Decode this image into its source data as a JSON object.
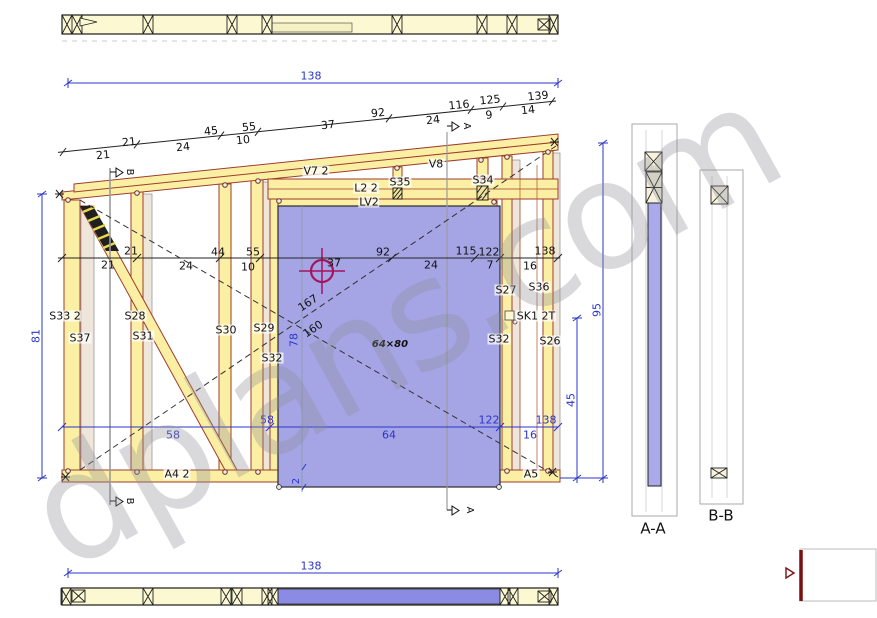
{
  "watermark_text": "dplans.com",
  "dimensions": {
    "overall_width_top": "138",
    "overall_width_bottom": "138",
    "left_height": "81",
    "right_height": "95",
    "right_inner_height": "45",
    "opening_height_ext": "78",
    "sill_offset": "2",
    "diagonal_upper": "167",
    "diagonal_lower": "160",
    "opening_size": "64×80",
    "incline_above": [
      "21",
      "45",
      "55",
      "37",
      "92",
      "116",
      "125",
      "139"
    ],
    "incline_below": [
      "21",
      "24",
      "10",
      "24",
      "9",
      "14"
    ],
    "mid_above": [
      "21",
      "44",
      "55",
      "37",
      "92",
      "115",
      "122",
      "138"
    ],
    "mid_below": [
      "21",
      "24",
      "10",
      "24",
      "7",
      "16"
    ],
    "bottom_above": [
      "58",
      "122",
      "138"
    ],
    "bottom_below": [
      "58",
      "64",
      "16"
    ]
  },
  "labels": {
    "v7_plate": "V7 2",
    "v8_plate": "V8",
    "l2_beam": "L2 2",
    "lv2_header": "LV2",
    "s35": "S35",
    "s34": "S34",
    "s33": "S33 2",
    "s37": "S37",
    "s28": "S28",
    "s31": "S31",
    "s30": "S30",
    "s29": "S29",
    "s32_left": "S32",
    "s27": "S27",
    "s36": "S36",
    "sk1": "SK1 2T",
    "s32_right": "S32",
    "s26": "S26",
    "a4_plate": "A4 2",
    "a5_plate": "A5"
  },
  "sections": {
    "a_a": "A-A",
    "b_b": "B-B",
    "marker_a": "A",
    "marker_b": "B"
  },
  "colors": {
    "timber": "#FBEFA4",
    "timber_outline": "#9E3D2B",
    "opening": "#A5A5E6",
    "dim_blue": "#2B35C8",
    "marker_red": "#A3155C",
    "detail_red": "#7A0F0F",
    "watermark": "#8D8D95"
  }
}
